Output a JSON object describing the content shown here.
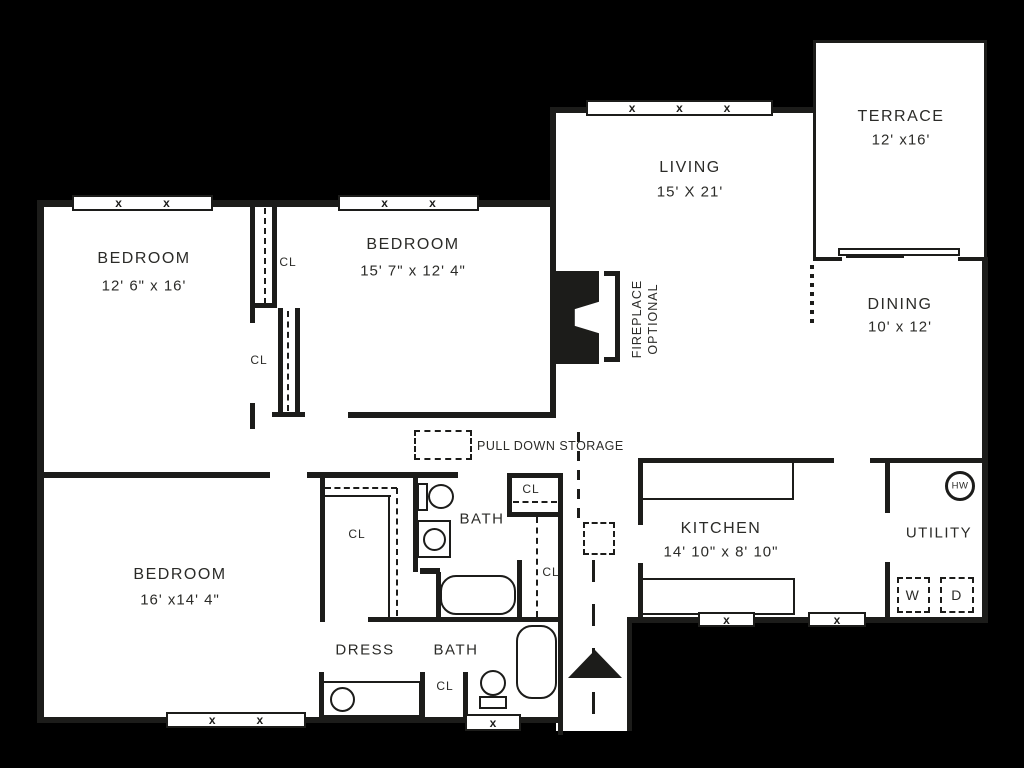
{
  "plan": {
    "rooms": [
      {
        "name": "BEDROOM",
        "dims": "12' 6\" x 16'"
      },
      {
        "name": "BEDROOM",
        "dims": "15' 7\" x 12' 4\""
      },
      {
        "name": "LIVING",
        "dims": "15' X 21'"
      },
      {
        "name": "TERRACE",
        "dims": "12' x16'"
      },
      {
        "name": "DINING",
        "dims": "10' x 12'"
      },
      {
        "name": "BEDROOM",
        "dims": "16' x14' 4\""
      },
      {
        "name": "KITCHEN",
        "dims": "14' 10\" x 8' 10\""
      },
      {
        "name": "UTILITY",
        "dims": ""
      },
      {
        "name": "BATH",
        "dims": ""
      },
      {
        "name": "BATH",
        "dims": ""
      },
      {
        "name": "DRESS",
        "dims": ""
      }
    ],
    "labels": {
      "closet": "CL",
      "fireplace": [
        "FIREPLACE",
        "OPTIONAL"
      ],
      "pull_down_storage": "PULL DOWN STORAGE",
      "hot_water_heater": "HW",
      "washer": "W",
      "dryer": "D",
      "window_mark": "x"
    },
    "colors": {
      "background": "#000000",
      "wall": "#1c1c1a",
      "floor": "#ffffff",
      "text": "#2b2b28"
    }
  }
}
